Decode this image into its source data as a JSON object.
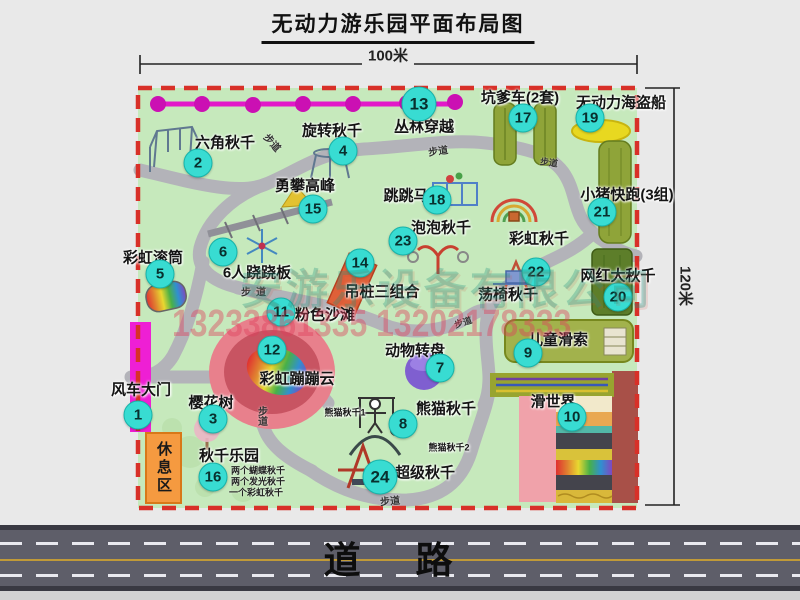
{
  "title": "无动力游乐园平面布局图",
  "dimensions": {
    "width": "100米",
    "height": "120米"
  },
  "road": {
    "label": "道路"
  },
  "walkway_label": "步道",
  "rest_area": {
    "label": "休息区"
  },
  "watermark": {
    "company": "安游乐设备有限公司",
    "phone": "13233861335 13202178333"
  },
  "rainbow_swing_label": "彩虹秋千",
  "attractions": [
    {
      "num": "1",
      "label": "风车大门"
    },
    {
      "num": "2",
      "label": "六角秋千"
    },
    {
      "num": "3",
      "label": "樱花树"
    },
    {
      "num": "4",
      "label": "旋转秋千"
    },
    {
      "num": "5",
      "label": "彩虹滚筒"
    },
    {
      "num": "6",
      "label": "6人跷跷板"
    },
    {
      "num": "7",
      "label": "动物转盘"
    },
    {
      "num": "8",
      "label": "熊猫秋千",
      "sub1": "熊猫秋千1",
      "sub2": "熊猫秋千2"
    },
    {
      "num": "9",
      "label": "儿童滑索"
    },
    {
      "num": "10",
      "label": "滑世界"
    },
    {
      "num": "11",
      "label": "粉色沙滩"
    },
    {
      "num": "12",
      "label": "彩虹蹦蹦云"
    },
    {
      "num": "13",
      "label": "丛林穿越"
    },
    {
      "num": "14",
      "label": "吊桩三组合"
    },
    {
      "num": "15",
      "label": "勇攀高峰"
    },
    {
      "num": "16",
      "label": "秋千乐园",
      "note1": "两个蝴蝶秋千",
      "note2": "两个发光秋千",
      "note3": "一个彩虹秋千"
    },
    {
      "num": "17",
      "label": "坑爹车(2套)"
    },
    {
      "num": "18",
      "label": "跳跳马"
    },
    {
      "num": "19",
      "label": "无动力海盗船"
    },
    {
      "num": "20",
      "label": "网红大秋千"
    },
    {
      "num": "21",
      "label": "小猪快跑(3组)"
    },
    {
      "num": "22",
      "label": "荡椅秋千"
    },
    {
      "num": "23",
      "label": "泡泡秋千"
    },
    {
      "num": "24",
      "label": "超级秋千"
    }
  ]
}
